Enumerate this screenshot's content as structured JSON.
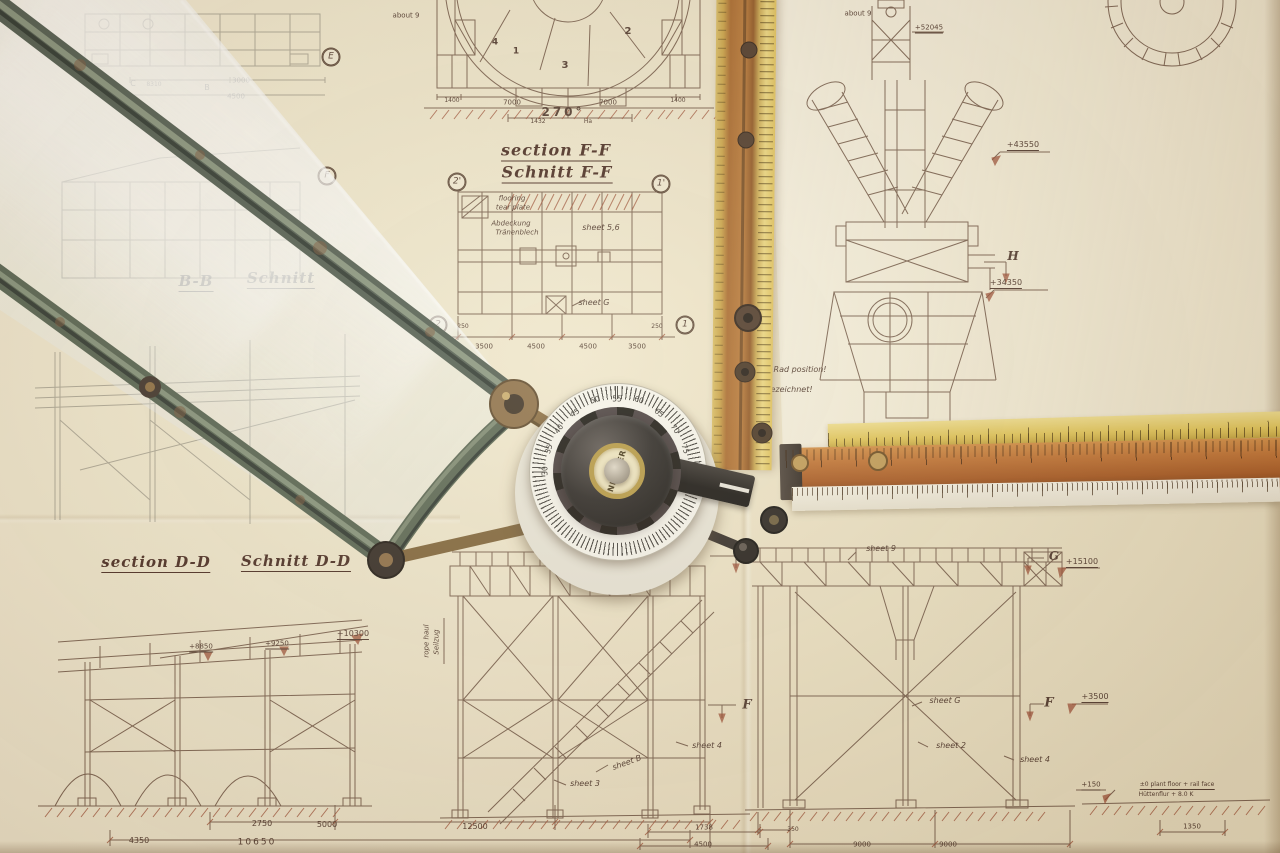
{
  "scene": {
    "description": "Photograph of engineering section drawings on a drafting board with a drafting machine, NESTLER protractor head, rulers and a glass pane",
    "colors": {
      "paper": "#efe6cc",
      "paper_bright": "#f6f1de",
      "ink": "#6b5140",
      "ink_red": "#9a4a30",
      "heading": "#46281f",
      "arm_green": "#55624f",
      "brass": "#8a6b43",
      "ruler_orange": "#b4662a",
      "ruler_yellow": "#e3c95f",
      "knob_black": "#23211f",
      "dial_white": "#f4f1e6"
    }
  },
  "protractor": {
    "brand": "NESTLER",
    "scale_numbers": [
      "30",
      "35",
      "40",
      "45",
      "50",
      "55",
      "60",
      "65",
      "70",
      "75"
    ]
  },
  "labels": {
    "section_ff_en": "section F-F",
    "section_ff_de": "Schnitt F-F",
    "section_dd_en": "section D-D",
    "section_dd_de": "Schnitt D-D",
    "section_bb": "B-B",
    "schnitt_bb": "Schnitt",
    "about9_left": "about 9",
    "about9_right": "about 9",
    "e52045": "+52045",
    "flooring1": "flooring",
    "flooring2": "tear plate",
    "abdeckung1": "Abdeckung",
    "abdeckung2": "Tränenblech",
    "sheet56": "sheet 5,6",
    "sheetG_ff": "sheet G",
    "e43550": "+43550",
    "h": "H",
    "e34350": "+34350",
    "rad_position": "Rad position!",
    "gezeichnet": "gezeichnet!",
    "e26725": "+26725",
    "sheet9": "sheet 9",
    "g_left": "G",
    "g_right": "G",
    "e15100": "+15100",
    "f_left": "F",
    "f_right": "F",
    "e3500": "+3500",
    "sheetG_tower": "sheet G",
    "sheet2": "sheet 2",
    "sheet4_right": "sheet 4",
    "e150": "+150",
    "plant_floor": "±0  plant floor + rail face",
    "huettenflur": "Hüttenflur + 8.0 K",
    "rope_haul": "rope haul",
    "seilzug": "Seilzug",
    "e8850": "+8850",
    "e9250": "+9250",
    "e10300": "+10300",
    "sheet4_mid": "sheet 4",
    "sheetB": "sheet B",
    "sheet3": "sheet 3",
    "c": "C",
    "d8310": "8310",
    "b": "B",
    "d3000": "3000",
    "d4500_tl": "4500",
    "m_e": "E",
    "m_f": "F",
    "m_2p": "2'",
    "m_1p": "1'",
    "m_2": "2",
    "m_1": "1",
    "p1": "1",
    "p2": "2",
    "p3": "3",
    "p4": "4",
    "d1400a": "1400",
    "d7000a": "7000",
    "d7000b": "7000",
    "d1400b": "1400",
    "angle270": "270°",
    "d1432": "1432",
    "ha": "Ha",
    "ff1": "3500",
    "ff2": "4500",
    "ff3": "4500",
    "ff4": "3500",
    "ff250a": "250",
    "ff250b": "250",
    "bl2750": "2750",
    "bl5000": "5000",
    "bl12500": "12500",
    "bl4350": "4350",
    "bl10650": "10650",
    "bm1738": "1738",
    "bm4500": "4500",
    "br350": "350",
    "br9000a": "9000",
    "br9000b": "9000",
    "br1350": "1350"
  }
}
